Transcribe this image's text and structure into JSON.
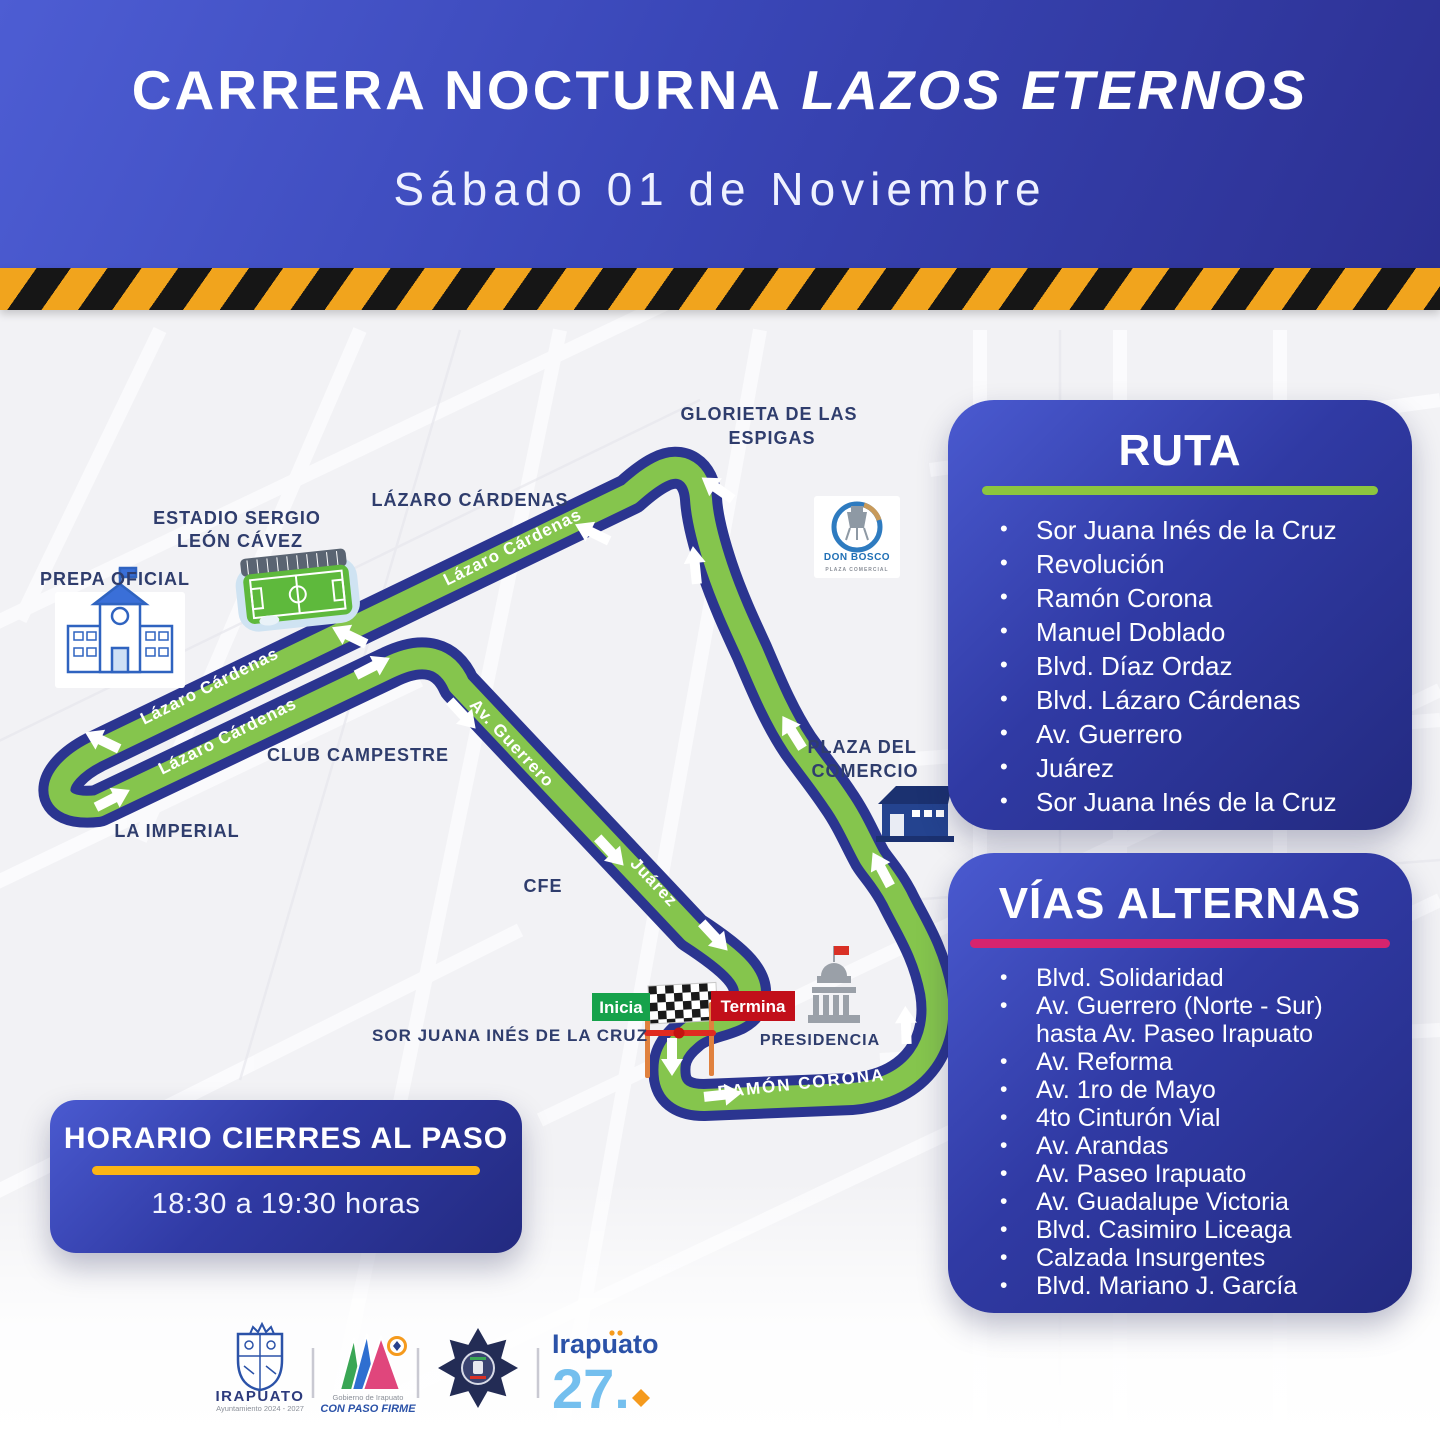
{
  "header": {
    "title_main": "CARRERA NOCTURNA",
    "title_italic": "LAZOS ETERNOS",
    "subtitle": "Sábado 01 de Noviembre"
  },
  "ruta": {
    "title": "RUTA",
    "items": [
      "Sor Juana Inés de la Cruz",
      "Revolución",
      "Ramón Corona",
      "Manuel Doblado",
      "Blvd. Díaz Ordaz",
      "Blvd.  Lázaro Cárdenas",
      "Av. Guerrero",
      "Juárez",
      "Sor Juana Inés de la Cruz"
    ]
  },
  "vias": {
    "title": "VÍAS ALTERNAS",
    "items": [
      "Blvd. Solidaridad",
      "Av. Guerrero (Norte - Sur) hasta Av. Paseo Irapuato",
      "Av. Reforma",
      "Av. 1ro de Mayo",
      "4to Cinturón Vial",
      "Av. Arandas",
      "Av. Paseo Irapuato",
      "Av. Guadalupe Victoria",
      "Blvd. Casimiro Liceaga",
      "Calzada Insurgentes",
      "Blvd. Mariano J. García"
    ]
  },
  "horario": {
    "title": "HORARIO CIERRES AL PASO",
    "time": "18:30 a 19:30 horas"
  },
  "map": {
    "labels": {
      "glorieta1": "GLORIETA DE LAS",
      "glorieta2": "ESPIGAS",
      "lazaro_top": "LÁZARO CÁRDENAS",
      "estadio1": "ESTADIO SERGIO",
      "estadio2": "LEÓN CÁVEZ",
      "prepa": "PREPA OFICIAL",
      "club": "CLUB CAMPESTRE",
      "imperial": "LA IMPERIAL",
      "cfe": "CFE",
      "plaza1": "PLAZA DEL",
      "plaza2": "COMERCIO",
      "presidencia": "PRESIDENCIA",
      "sorjuana": "SOR JUANA INÉS DE LA CRUZ"
    },
    "streets": {
      "lazaro": "Lázaro Cárdenas",
      "guerrero": "Av. Guerrero",
      "juarez": "Juárez",
      "ramon": "RAMÓN CORONA"
    },
    "markers": {
      "start": "Inicia",
      "finish": "Termina"
    },
    "donbosco": {
      "name": "DON BOSCO",
      "sub": "PLAZA COMERCIAL"
    },
    "icons": [
      "stadium-icon",
      "school-icon",
      "warehouse-icon",
      "government-building-icon",
      "checkered-flag-icon",
      "water-tower-icon"
    ]
  },
  "footer": {
    "irapuato_wordmark": "IRAPUATO",
    "ayuntamiento": "Ayuntamiento 2024 - 2027",
    "gobierno": "Gobierno de Irapuato",
    "con_paso_firme": "CON PASO FIRME",
    "irapuato27_name": "Irapuato",
    "irapuato27_number": "27."
  },
  "colors": {
    "route_green": "#85c54d",
    "route_navy": "#2b3590",
    "panel_blue_light": "#4a5ad0",
    "panel_blue_dark": "#232a80",
    "bar_green": "#8cc63f",
    "bar_pink": "#d6246e",
    "bar_yellow": "#fcb515",
    "start_green": "#16a24b",
    "finish_red": "#c20f1a",
    "hazard_yellow": "#f1a41d",
    "label_navy": "#2f3d6d"
  }
}
